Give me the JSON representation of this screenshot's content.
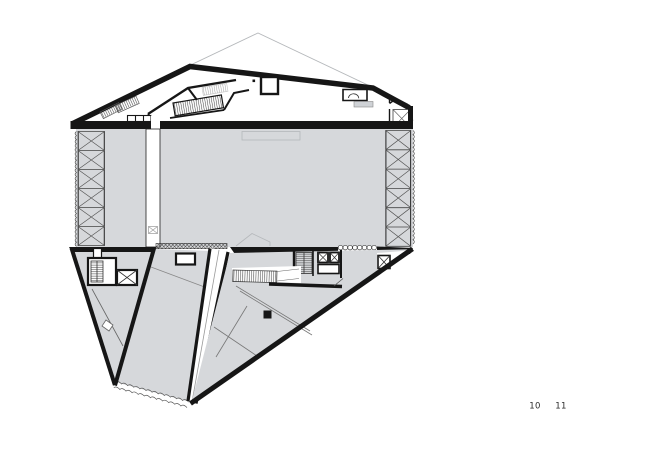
{
  "page": {
    "numbers": {
      "left": "10",
      "right": "11"
    }
  },
  "colors": {
    "ink": "#161616",
    "floor": "#d6d8db",
    "faint": "#b5b8bb",
    "paper": "#ffffff"
  }
}
